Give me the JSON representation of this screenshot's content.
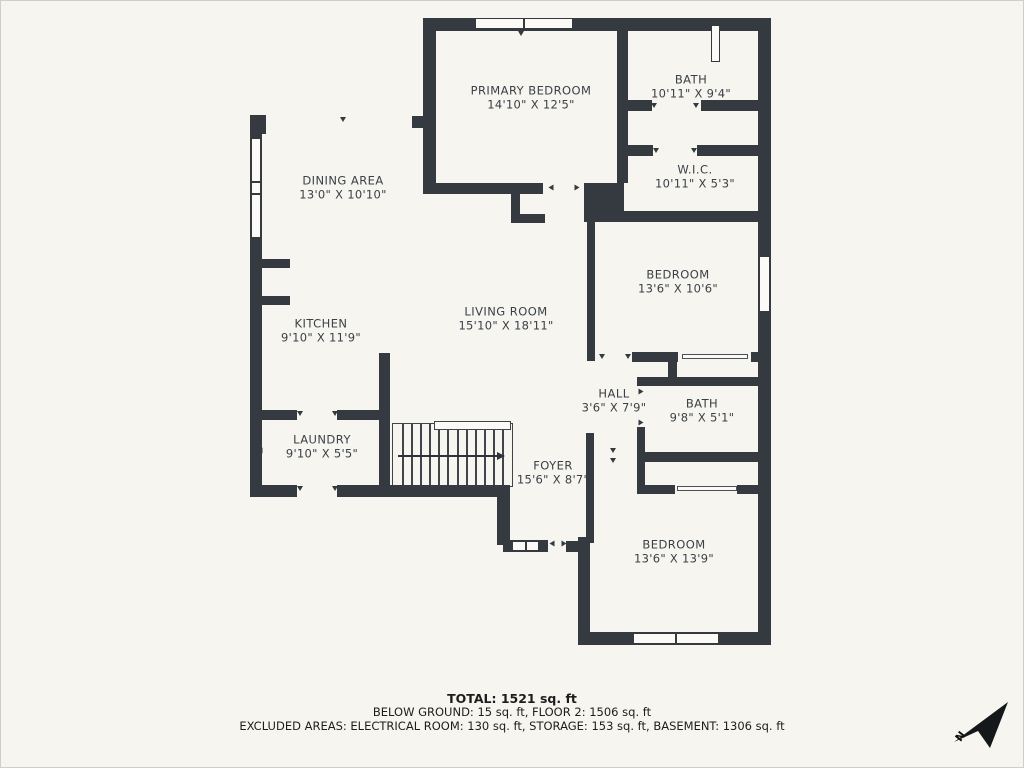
{
  "meta": {
    "background_color": "#f6f5ef",
    "wall_color": "#343a40",
    "text_color": "#3b4148"
  },
  "floorplan": {
    "rooms": [
      {
        "id": "primary-bedroom",
        "name": "PRIMARY BEDROOM",
        "dims": "14'10\" X 12'5\"",
        "cx": 531,
        "cy": 98
      },
      {
        "id": "bath-upper",
        "name": "BATH",
        "dims": "10'11\" X 9'4\"",
        "cx": 691,
        "cy": 87
      },
      {
        "id": "wic",
        "name": "W.I.C.",
        "dims": "10'11\" X 5'3\"",
        "cx": 695,
        "cy": 177
      },
      {
        "id": "dining-area",
        "name": "DINING AREA",
        "dims": "13'0\" X 10'10\"",
        "cx": 343,
        "cy": 188
      },
      {
        "id": "bedroom-1",
        "name": "BEDROOM",
        "dims": "13'6\" X 10'6\"",
        "cx": 678,
        "cy": 282
      },
      {
        "id": "kitchen",
        "name": "KITCHEN",
        "dims": "9'10\" X 11'9\"",
        "cx": 321,
        "cy": 331
      },
      {
        "id": "living-room",
        "name": "LIVING ROOM",
        "dims": "15'10\" X 18'11\"",
        "cx": 506,
        "cy": 319
      },
      {
        "id": "hall",
        "name": "HALL",
        "dims": "3'6\" X 7'9\"",
        "cx": 614,
        "cy": 401
      },
      {
        "id": "bath-lower",
        "name": "BATH",
        "dims": "9'8\" X 5'1\"",
        "cx": 702,
        "cy": 411
      },
      {
        "id": "laundry",
        "name": "LAUNDRY",
        "dims": "9'10\" X 5'5\"",
        "cx": 322,
        "cy": 447
      },
      {
        "id": "foyer",
        "name": "FOYER",
        "dims": "15'6\" X 8'7\"",
        "cx": 553,
        "cy": 473
      },
      {
        "id": "bedroom-2",
        "name": "BEDROOM",
        "dims": "13'6\" X 13'9\"",
        "cx": 674,
        "cy": 552
      }
    ],
    "walls": [
      [
        423,
        18,
        347,
        13
      ],
      [
        758,
        18,
        13,
        627
      ],
      [
        578,
        632,
        193,
        13
      ],
      [
        578,
        537,
        12,
        103
      ],
      [
        566,
        541,
        24,
        11
      ],
      [
        503,
        540,
        45,
        12
      ],
      [
        497,
        490,
        13,
        55
      ],
      [
        378,
        485,
        132,
        12
      ],
      [
        250,
        485,
        47,
        12
      ],
      [
        337,
        485,
        53,
        12
      ],
      [
        250,
        115,
        12,
        382
      ],
      [
        250,
        115,
        16,
        19
      ],
      [
        412,
        116,
        13,
        12
      ],
      [
        423,
        18,
        13,
        175
      ],
      [
        423,
        183,
        120,
        11
      ],
      [
        511,
        192,
        9,
        30
      ],
      [
        511,
        214,
        34,
        9
      ],
      [
        584,
        183,
        40,
        39
      ],
      [
        617,
        31,
        11,
        152
      ],
      [
        628,
        100,
        24,
        11
      ],
      [
        701,
        100,
        57,
        11
      ],
      [
        628,
        145,
        25,
        11
      ],
      [
        697,
        145,
        61,
        11
      ],
      [
        624,
        211,
        134,
        11
      ],
      [
        587,
        222,
        8,
        139
      ],
      [
        632,
        352,
        46,
        10
      ],
      [
        751,
        352,
        19,
        10
      ],
      [
        668,
        361,
        9,
        18
      ],
      [
        637,
        377,
        121,
        9
      ],
      [
        637,
        427,
        8,
        66
      ],
      [
        637,
        452,
        121,
        10
      ],
      [
        637,
        485,
        38,
        9
      ],
      [
        737,
        485,
        21,
        9
      ],
      [
        586,
        433,
        8,
        110
      ],
      [
        379,
        353,
        11,
        144
      ],
      [
        250,
        410,
        47,
        10
      ],
      [
        337,
        410,
        53,
        10
      ],
      [
        262,
        259,
        28,
        9
      ],
      [
        262,
        296,
        28,
        9
      ]
    ],
    "windows": [
      {
        "x": 475,
        "y": 18,
        "w": 98,
        "h": 11,
        "mullions": [
          0.5
        ],
        "dir": "h"
      },
      {
        "x": 251,
        "y": 138,
        "w": 10,
        "h": 100,
        "mullions": [
          0.44,
          0.56
        ],
        "dir": "v"
      },
      {
        "x": 759,
        "y": 256,
        "w": 11,
        "h": 56,
        "mullions": [],
        "dir": "v"
      },
      {
        "x": 633,
        "y": 633,
        "w": 86,
        "h": 11,
        "mullions": [
          0.5
        ],
        "dir": "h"
      },
      {
        "x": 512,
        "y": 541,
        "w": 27,
        "h": 10,
        "mullions": [
          0.5
        ],
        "dir": "h"
      },
      {
        "x": 711,
        "y": 25,
        "w": 9,
        "h": 37,
        "mullions": [],
        "dir": "v"
      }
    ],
    "thin_lines": [
      [
        682,
        354,
        66,
        5
      ],
      [
        677,
        486,
        60,
        5
      ]
    ],
    "door_ticks": [
      [
        343,
        120,
        0
      ],
      [
        521,
        34,
        0
      ],
      [
        551,
        188,
        90
      ],
      [
        577,
        188,
        -90
      ],
      [
        654,
        106,
        0
      ],
      [
        696,
        106,
        0
      ],
      [
        656,
        151,
        0
      ],
      [
        694,
        151,
        0
      ],
      [
        602,
        357,
        0
      ],
      [
        628,
        357,
        0
      ],
      [
        641,
        392,
        -90
      ],
      [
        641,
        423,
        -90
      ],
      [
        613,
        451,
        0
      ],
      [
        613,
        461,
        0
      ],
      [
        300,
        414,
        0
      ],
      [
        335,
        414,
        0
      ],
      [
        300,
        489,
        0
      ],
      [
        335,
        489,
        0
      ],
      [
        552,
        544,
        90
      ],
      [
        564,
        544,
        -90
      ],
      [
        260,
        451,
        90
      ]
    ],
    "stairs": {
      "x": 392,
      "y": 423,
      "w": 121,
      "h": 64,
      "treads": 12,
      "rail": {
        "x": 434,
        "y": 421,
        "w": 77,
        "h": 9
      },
      "arrow": {
        "x": 398,
        "y": 455,
        "len": 100
      }
    }
  },
  "footer": {
    "total": "TOTAL: 1521 sq. ft",
    "line2": "BELOW GROUND: 15 sq. ft, FLOOR 2: 1506 sq. ft",
    "line3": "EXCLUDED AREAS: ELECTRICAL ROOM: 130 sq. ft, STORAGE: 153 sq. ft, BASEMENT: 1306 sq. ft"
  },
  "compass": {
    "label": "N"
  }
}
